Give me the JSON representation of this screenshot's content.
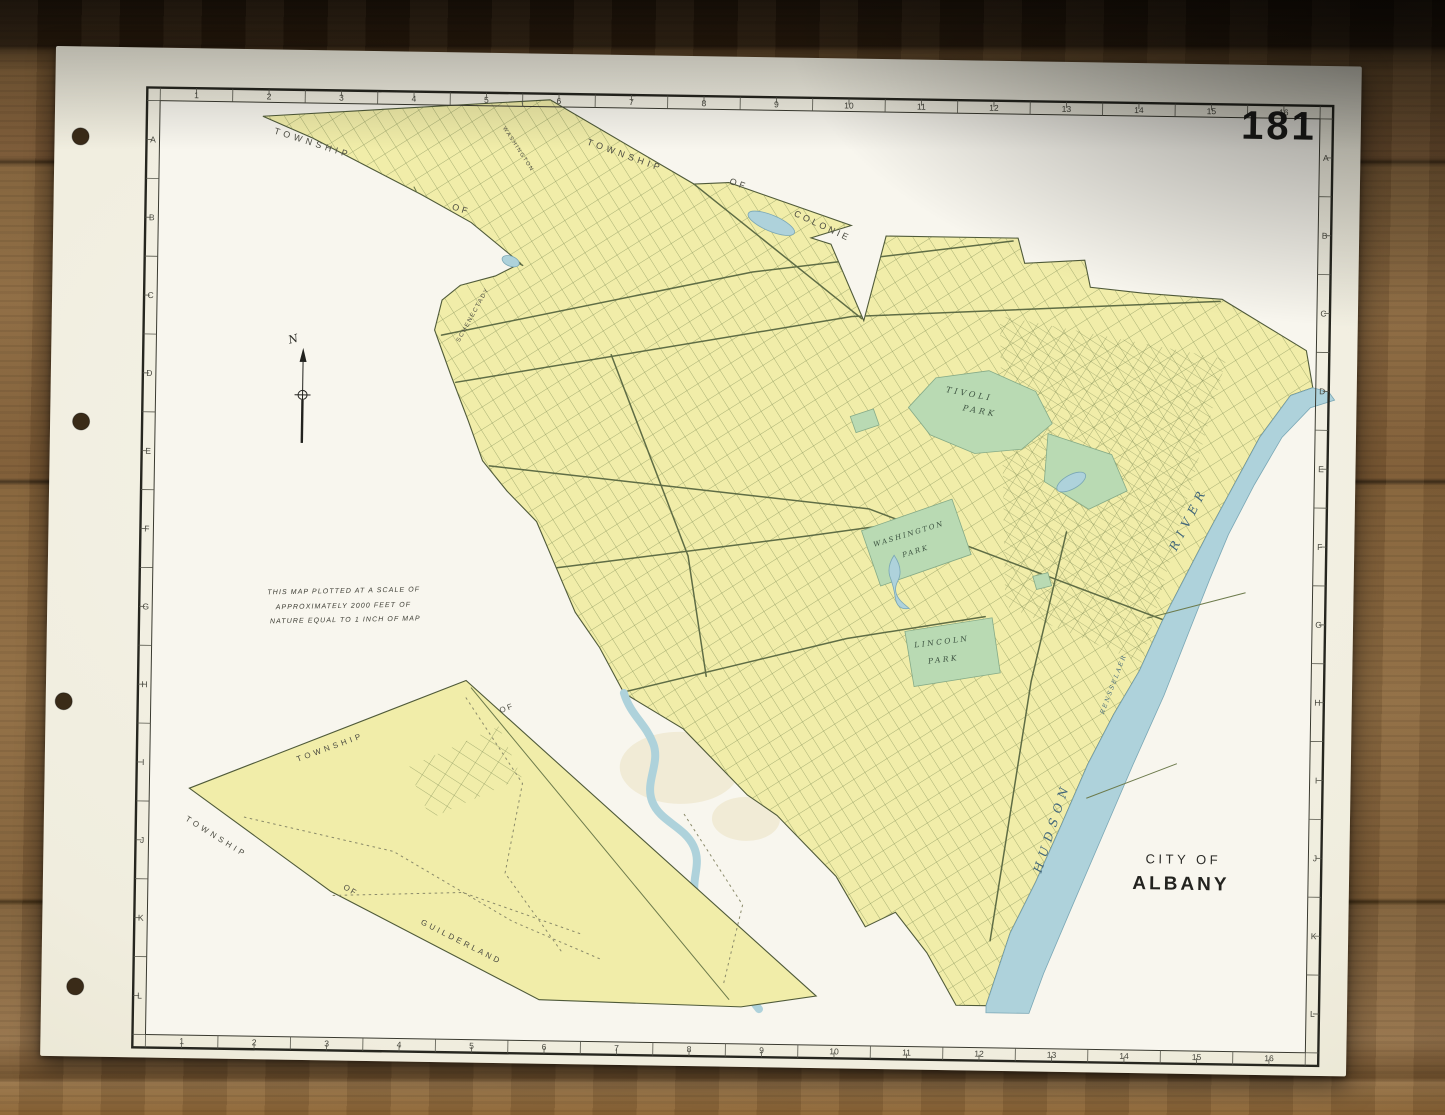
{
  "page": {
    "number": "181"
  },
  "title": {
    "line1": "CITY OF",
    "line2": "ALBANY"
  },
  "compass": {
    "label": "N"
  },
  "scale_note": {
    "line1": "THIS MAP PLOTTED AT A SCALE OF",
    "line2": "APPROXIMATELY  2000 FEET OF",
    "line3": "NATURE EQUAL TO 1 INCH OF MAP"
  },
  "grid": {
    "columns": [
      "1",
      "2",
      "3",
      "4",
      "5",
      "6",
      "7",
      "8",
      "9",
      "10",
      "11",
      "12",
      "13",
      "14",
      "15",
      "16"
    ],
    "rows": [
      "A",
      "B",
      "C",
      "D",
      "E",
      "F",
      "G",
      "H",
      "I",
      "J",
      "K",
      "L"
    ]
  },
  "colors": {
    "paper": "#f2efe3",
    "city_yellow": "#f1eda9",
    "park_green": "#b9dab3",
    "water_blue": "#aed2db",
    "ink": "#26261f",
    "street_olive": "#6c7a4b",
    "wood_brown": "#7b5a34"
  },
  "map_labels": [
    {
      "name": "township-label-nw",
      "text": "TOWNSHIP",
      "x": 219,
      "y": 84,
      "r": 17,
      "s": 9,
      "ls": 4,
      "cls": "lbl-town"
    },
    {
      "name": "of-label-nw",
      "text": "OF",
      "x": 398,
      "y": 157,
      "r": 17,
      "s": 9,
      "ls": 3,
      "cls": "lbl-town"
    },
    {
      "name": "township-label-n",
      "text": "TOWNSHIP",
      "x": 532,
      "y": 90,
      "r": 19,
      "s": 9,
      "ls": 4,
      "cls": "lbl-town"
    },
    {
      "name": "of-label-n",
      "text": "OF",
      "x": 675,
      "y": 127,
      "r": 19,
      "s": 9,
      "ls": 3,
      "cls": "lbl-town"
    },
    {
      "name": "colonie-label",
      "text": "COLONIE",
      "x": 740,
      "y": 158,
      "r": 24,
      "s": 9,
      "ls": 3,
      "cls": "lbl-town"
    },
    {
      "name": "washington-ave-label",
      "text": "WASHINGTON",
      "x": 448,
      "y": 75,
      "r": 56,
      "s": 5.5,
      "ls": 1.5,
      "cls": "lbl-town"
    },
    {
      "name": "schenectady-label",
      "text": "SCHENECTADY",
      "x": 408,
      "y": 290,
      "r": -62,
      "s": 6,
      "ls": 1.5,
      "cls": "lbl-town"
    },
    {
      "name": "tivoli-park-label-1",
      "text": "TIVOLI",
      "x": 895,
      "y": 332,
      "r": 10,
      "s": 8,
      "ls": 3,
      "cls": "lbl-park"
    },
    {
      "name": "tivoli-park-label-2",
      "text": "PARK",
      "x": 912,
      "y": 350,
      "r": 10,
      "s": 8,
      "ls": 3,
      "cls": "lbl-park"
    },
    {
      "name": "washington-park-label-1",
      "text": "WASHINGTON",
      "x": 826,
      "y": 488,
      "r": -18,
      "s": 7,
      "ls": 2,
      "cls": "lbl-park"
    },
    {
      "name": "washington-park-label-2",
      "text": "PARK",
      "x": 855,
      "y": 498,
      "r": -18,
      "s": 7,
      "ls": 2,
      "cls": "lbl-park"
    },
    {
      "name": "lincoln-park-label-1",
      "text": "LINCOLN",
      "x": 868,
      "y": 588,
      "r": -8,
      "s": 7.5,
      "ls": 2.5,
      "cls": "lbl-park"
    },
    {
      "name": "lincoln-park-label-2",
      "text": "PARK",
      "x": 882,
      "y": 604,
      "r": -8,
      "s": 7.5,
      "ls": 2.5,
      "cls": "lbl-park"
    },
    {
      "name": "hudson-label",
      "text": "HUDSON",
      "x": 998,
      "y": 812,
      "r": -73,
      "s": 12,
      "ls": 6,
      "cls": "lbl-water"
    },
    {
      "name": "river-label",
      "text": "RIVER",
      "x": 1128,
      "y": 488,
      "r": -64,
      "s": 12,
      "ls": 6,
      "cls": "lbl-water"
    },
    {
      "name": "rensselaer-label",
      "text": "RENSSELAER",
      "x": 1058,
      "y": 652,
      "r": -70,
      "s": 6,
      "ls": 2,
      "cls": "lbl-water"
    },
    {
      "name": "township-label-wedge-n",
      "text": "TOWNSHIP",
      "x": 253,
      "y": 712,
      "r": -21,
      "s": 8,
      "ls": 3.5,
      "cls": "lbl-town"
    },
    {
      "name": "of-label-wedge-n",
      "text": "OF",
      "x": 455,
      "y": 660,
      "r": -21,
      "s": 8,
      "ls": 2,
      "cls": "lbl-town"
    },
    {
      "name": "township-label-wedge-s",
      "text": "TOWNSHIP",
      "x": 141,
      "y": 772,
      "r": 31,
      "s": 8,
      "ls": 3.5,
      "cls": "lbl-town"
    },
    {
      "name": "of-label-wedge-s",
      "text": "OF",
      "x": 300,
      "y": 838,
      "r": 29,
      "s": 8,
      "ls": 2,
      "cls": "lbl-town"
    },
    {
      "name": "guilderland-label",
      "text": "GUILDERLAND",
      "x": 378,
      "y": 872,
      "r": 26,
      "s": 8,
      "ls": 3,
      "cls": "lbl-town"
    }
  ]
}
